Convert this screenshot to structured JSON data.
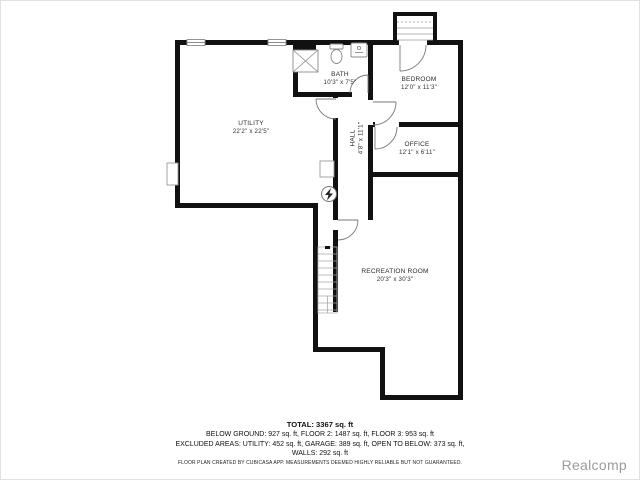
{
  "rooms": {
    "utility": {
      "name": "UTILITY",
      "dims": "22'2\" x 22'5\""
    },
    "bath": {
      "name": "BATH",
      "dims": "10'3\" x 7'5\""
    },
    "bedroom": {
      "name": "BEDROOM",
      "dims": "12'0\" x 11'3\""
    },
    "office": {
      "name": "OFFICE",
      "dims": "12'1\" x 6'11\""
    },
    "hall": {
      "name": "HALL",
      "dims": "4'8\" x 11'1\""
    },
    "recreation": {
      "name": "RECREATION ROOM",
      "dims": "20'3\" x 30'3\""
    }
  },
  "summary": {
    "total": "TOTAL: 3367 sq. ft",
    "floors": "BELOW GROUND: 927 sq. ft, FLOOR 2: 1487 sq. ft, FLOOR 3: 953 sq. ft",
    "excluded": "EXCLUDED AREAS: UTILITY: 452 sq. ft, GARAGE: 389 sq. ft, OPEN TO BELOW: 373 sq. ft,",
    "walls": "WALLS: 292 sq. ft",
    "disclaimer": "FLOOR PLAN CREATED BY CUBICASA APP. MEASUREMENTS DEEMED HIGHLY RELIABLE BUT NOT GUARANTEED."
  },
  "watermark": "Realcomp",
  "colors": {
    "wall": "#111111",
    "fixture_stroke": "#8a8a8a",
    "watermark": "#9b9b9b"
  }
}
